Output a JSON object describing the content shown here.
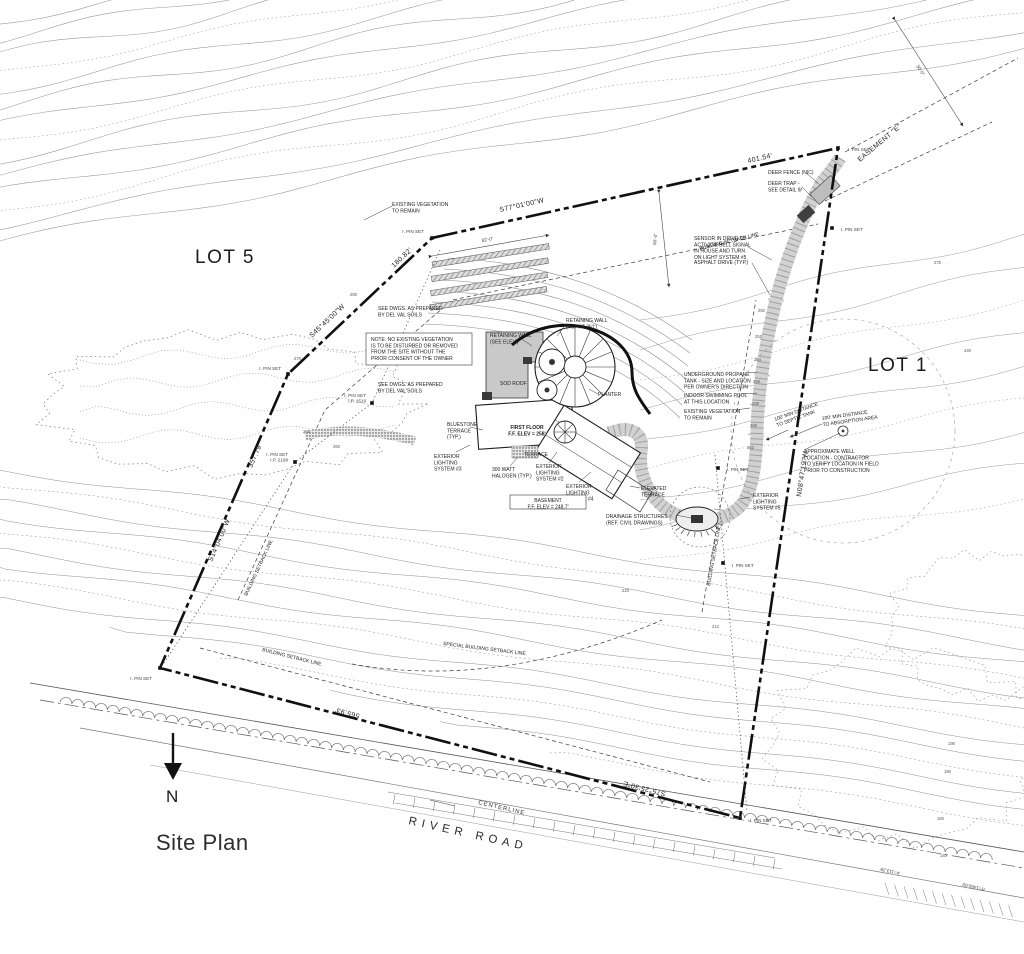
{
  "titleblock": {
    "site_plan": "Site Plan",
    "north": "N"
  },
  "lots": {
    "lot5": "LOT 5",
    "lot1": "LOT 1"
  },
  "road": {
    "name": "RIVER ROAD",
    "centerline": "CENTERLINE",
    "curve_radius": "R=1460.00'",
    "curve_arc": "A=113.29'"
  },
  "boundary": {
    "top": {
      "bearing": "S77°01'00\"W",
      "length": "401.54'"
    },
    "upper_left": {
      "bearing": "S45°45'00\"W",
      "length": "180.82'"
    },
    "left": {
      "bearing": "S14°04'00\"W",
      "length": "357.79'"
    },
    "bottom": {
      "bearing": "S75°25'30\"E",
      "length": "565.93'"
    },
    "right": {
      "bearing": "N08°47'19\"W"
    }
  },
  "easement": {
    "label": "EASEMENT \"E\"",
    "dim": "30'-0\""
  },
  "dims": {
    "setback": "60'-0\"",
    "garden": "82'-0\""
  },
  "pins": [
    {
      "x": 838,
      "y": 148,
      "tx": 848,
      "ty": 151,
      "anchor": "start",
      "lines": [
        "I. PIN SET"
      ]
    },
    {
      "x": 832,
      "y": 228,
      "tx": 841,
      "ty": 231,
      "anchor": "start",
      "lines": [
        "I. PIN SET"
      ]
    },
    {
      "x": 432,
      "y": 238,
      "tx": 424,
      "ty": 233,
      "anchor": "end",
      "lines": [
        "I. PIN SET"
      ]
    },
    {
      "x": 288,
      "y": 374,
      "tx": 281,
      "ty": 370,
      "anchor": "end",
      "lines": [
        "I. PIN SET"
      ]
    },
    {
      "x": 372,
      "y": 403,
      "tx": 366,
      "ty": 397,
      "anchor": "end",
      "lines": [
        "I. PIN SET",
        "I.P. 1519"
      ]
    },
    {
      "x": 295,
      "y": 462,
      "tx": 288,
      "ty": 456,
      "anchor": "end",
      "lines": [
        "I. PIN SET",
        "I.P. 2199"
      ]
    },
    {
      "x": 160,
      "y": 668,
      "tx": 152,
      "ty": 680,
      "anchor": "end",
      "lines": [
        "I. PIN SET"
      ]
    },
    {
      "x": 740,
      "y": 818,
      "tx": 750,
      "ty": 822,
      "anchor": "start",
      "lines": [
        "I. PIN SET"
      ]
    },
    {
      "x": 718,
      "y": 468,
      "tx": 727,
      "ty": 471,
      "anchor": "start",
      "lines": [
        "I. PIN SET"
      ]
    },
    {
      "x": 723,
      "y": 563,
      "tx": 732,
      "ty": 567,
      "anchor": "start",
      "lines": [
        "I. PIN SET"
      ]
    }
  ],
  "annotations": [
    {
      "id": "existing-vegetation-top",
      "x": 392,
      "y": 206,
      "lines": [
        "EXISTING VEGETATION",
        "TO REMAIN"
      ]
    },
    {
      "id": "sensor-note",
      "x": 694,
      "y": 240,
      "lines": [
        "SENSOR IN DRIVE TO",
        "ACTIVATE BELL SIGNAL",
        "IN HOUSE AND TURN",
        "ON LIGHT SYSTEM #5"
      ]
    },
    {
      "id": "asphalt-drive",
      "x": 694,
      "y": 264,
      "lines": [
        "ASPHALT DRIVE (TYP.)"
      ]
    },
    {
      "id": "deer-fence",
      "x": 768,
      "y": 174,
      "lines": [
        "DEER FENCE (NIC)"
      ]
    },
    {
      "id": "deer-trap",
      "x": 768,
      "y": 185,
      "lines": [
        "DEER TRAP -",
        "SEE DETAIL 9/"
      ]
    },
    {
      "id": "building-setback-top",
      "x": 700,
      "y": 250,
      "rot": -14,
      "lines": [
        "BUILDING SETBACK LINE"
      ]
    },
    {
      "id": "vegetation-note",
      "x": 371,
      "y": 341,
      "box": [
        366,
        333,
        106,
        32
      ],
      "lines": [
        "NOTE: NO EXISTING VEGETATION",
        "IS TO BE DISTURBED OR REMOVED",
        "FROM THE SITE WITHOUT THE",
        "PRIOR CONSENT OF THE OWNER"
      ]
    },
    {
      "id": "delval-a",
      "x": 378,
      "y": 310,
      "lines": [
        "SEE DWGS. AS PREPARED",
        "BY DEL VAL SOILS"
      ]
    },
    {
      "id": "delval-b",
      "x": 378,
      "y": 386,
      "lines": [
        "SEE DWGS. AS PREPARED",
        "BY DEL VAL SOILS"
      ]
    },
    {
      "id": "retaining-wall-left",
      "x": 490,
      "y": 337,
      "lines": [
        "RETAINING WALL",
        "(SEE ELEV.)"
      ]
    },
    {
      "id": "retaining-wall-right",
      "x": 566,
      "y": 322,
      "lines": [
        "RETAINING WALL",
        "(TOP AT 261')"
      ]
    },
    {
      "id": "sod-roof",
      "x": 500,
      "y": 385,
      "lines": [
        "SOD ROOF"
      ]
    },
    {
      "id": "planter",
      "x": 598,
      "y": 396,
      "lines": [
        "PLANTER"
      ]
    },
    {
      "id": "first-floor",
      "x": 527,
      "y": 429,
      "anchor": "middle",
      "bold": true,
      "lines": [
        "FIRST FLOOR",
        "F.F. ELEV = 258'"
      ]
    },
    {
      "id": "bluestone-terrace",
      "x": 447,
      "y": 426,
      "lines": [
        "BLUESTONE",
        "TERRACE",
        "(TYP.)"
      ]
    },
    {
      "id": "terrace",
      "x": 524,
      "y": 456,
      "lines": [
        "TERRACE"
      ]
    },
    {
      "id": "ext-lighting-3",
      "x": 434,
      "y": 458,
      "lines": [
        "EXTERIOR",
        "LIGHTING",
        "SYSTEM #3"
      ]
    },
    {
      "id": "halogen",
      "x": 492,
      "y": 471,
      "lines": [
        "300 WATT",
        "HALOGEN (TYP.)"
      ]
    },
    {
      "id": "ext-lighting-2",
      "x": 536,
      "y": 468,
      "lines": [
        "EXTERIOR",
        "LIGHTING",
        "SYSTEM #2"
      ]
    },
    {
      "id": "ext-lighting-4",
      "x": 566,
      "y": 488,
      "lines": [
        "EXTERIOR",
        "LIGHTING",
        "SYSTEM #4"
      ]
    },
    {
      "id": "basement",
      "x": 548,
      "y": 502,
      "anchor": "middle",
      "box": [
        510,
        495,
        76,
        14
      ],
      "lines": [
        "BASEMENT",
        "F.F. ELEV = 248.7'"
      ]
    },
    {
      "id": "elevated-terrace",
      "x": 641,
      "y": 490,
      "lines": [
        "ELEVATED",
        "TERRACE"
      ]
    },
    {
      "id": "drainage",
      "x": 606,
      "y": 518,
      "lines": [
        "DRAINAGE STRUCTURES",
        "(REF. CIVIL DRAWINGS)"
      ]
    },
    {
      "id": "ext-lighting-5",
      "x": 753,
      "y": 497,
      "lines": [
        "EXTERIOR",
        "LIGHTING",
        "SYSTEM #5"
      ]
    },
    {
      "id": "propane",
      "x": 684,
      "y": 376,
      "lines": [
        "UNDERGROUND PROPANE",
        "TANK - SIZE AND LOCATION",
        "PER OWNER'S DIRECTION"
      ]
    },
    {
      "id": "indoor-pool",
      "x": 684,
      "y": 397,
      "lines": [
        "INDOOR SWIMMING POOL",
        "AT THIS LOCATION"
      ]
    },
    {
      "id": "existing-vegetation-right",
      "x": 684,
      "y": 413,
      "lines": [
        "EXISTING VEGETATION",
        "TO REMAIN"
      ]
    },
    {
      "id": "septic-distance",
      "x": 775,
      "y": 421,
      "rot": -20,
      "lines": [
        "100' MIN DISTANCE",
        "TO SEPTIC TANK"
      ]
    },
    {
      "id": "absorption-distance",
      "x": 822,
      "y": 420,
      "rot": -8,
      "lines": [
        "100' MIN DISTANCE",
        "TO ABSORPTION AREA"
      ]
    },
    {
      "id": "well-note",
      "x": 804,
      "y": 453,
      "lines": [
        "APPROXIMATE WELL",
        "LOCATION - CONTRACTOR",
        "TO VERIFY LOCATION IN FIELD",
        "PRIOR TO CONSTRUCTION"
      ]
    },
    {
      "id": "building-setback-left",
      "x": 247,
      "y": 596,
      "rot": -65,
      "lines": [
        "BUILDING SETBACK LINE"
      ]
    },
    {
      "id": "building-setback-bottom",
      "x": 262,
      "y": 651,
      "rot": 14,
      "lines": [
        "BUILDING SETBACK LINE"
      ]
    },
    {
      "id": "special-setback",
      "x": 443,
      "y": 645,
      "rot": 7,
      "lines": [
        "SPECIAL BUILDING SETBACK LINE"
      ]
    },
    {
      "id": "building-setback-right",
      "x": 710,
      "y": 586,
      "rot": -80,
      "lines": [
        "BUILDING SETBACK LINE"
      ]
    }
  ],
  "contour_labels": [
    {
      "v": "280",
      "x": 350,
      "y": 296
    },
    {
      "v": "270",
      "x": 294,
      "y": 360
    },
    {
      "v": "265",
      "x": 303,
      "y": 433
    },
    {
      "v": "260",
      "x": 333,
      "y": 448
    },
    {
      "v": "275",
      "x": 934,
      "y": 264
    },
    {
      "v": "240",
      "x": 964,
      "y": 352
    },
    {
      "v": "250",
      "x": 758,
      "y": 312
    },
    {
      "v": "252",
      "x": 755,
      "y": 338
    },
    {
      "v": "254",
      "x": 754,
      "y": 361
    },
    {
      "v": "256",
      "x": 753,
      "y": 383
    },
    {
      "v": "258",
      "x": 752,
      "y": 405
    },
    {
      "v": "260",
      "x": 750,
      "y": 427
    },
    {
      "v": "262",
      "x": 747,
      "y": 449
    },
    {
      "v": "220",
      "x": 622,
      "y": 592
    },
    {
      "v": "212",
      "x": 712,
      "y": 628
    },
    {
      "v": "140",
      "x": 940,
      "y": 857
    },
    {
      "v": "160",
      "x": 937,
      "y": 820
    },
    {
      "v": "180",
      "x": 944,
      "y": 773
    },
    {
      "v": "190",
      "x": 948,
      "y": 745
    }
  ]
}
